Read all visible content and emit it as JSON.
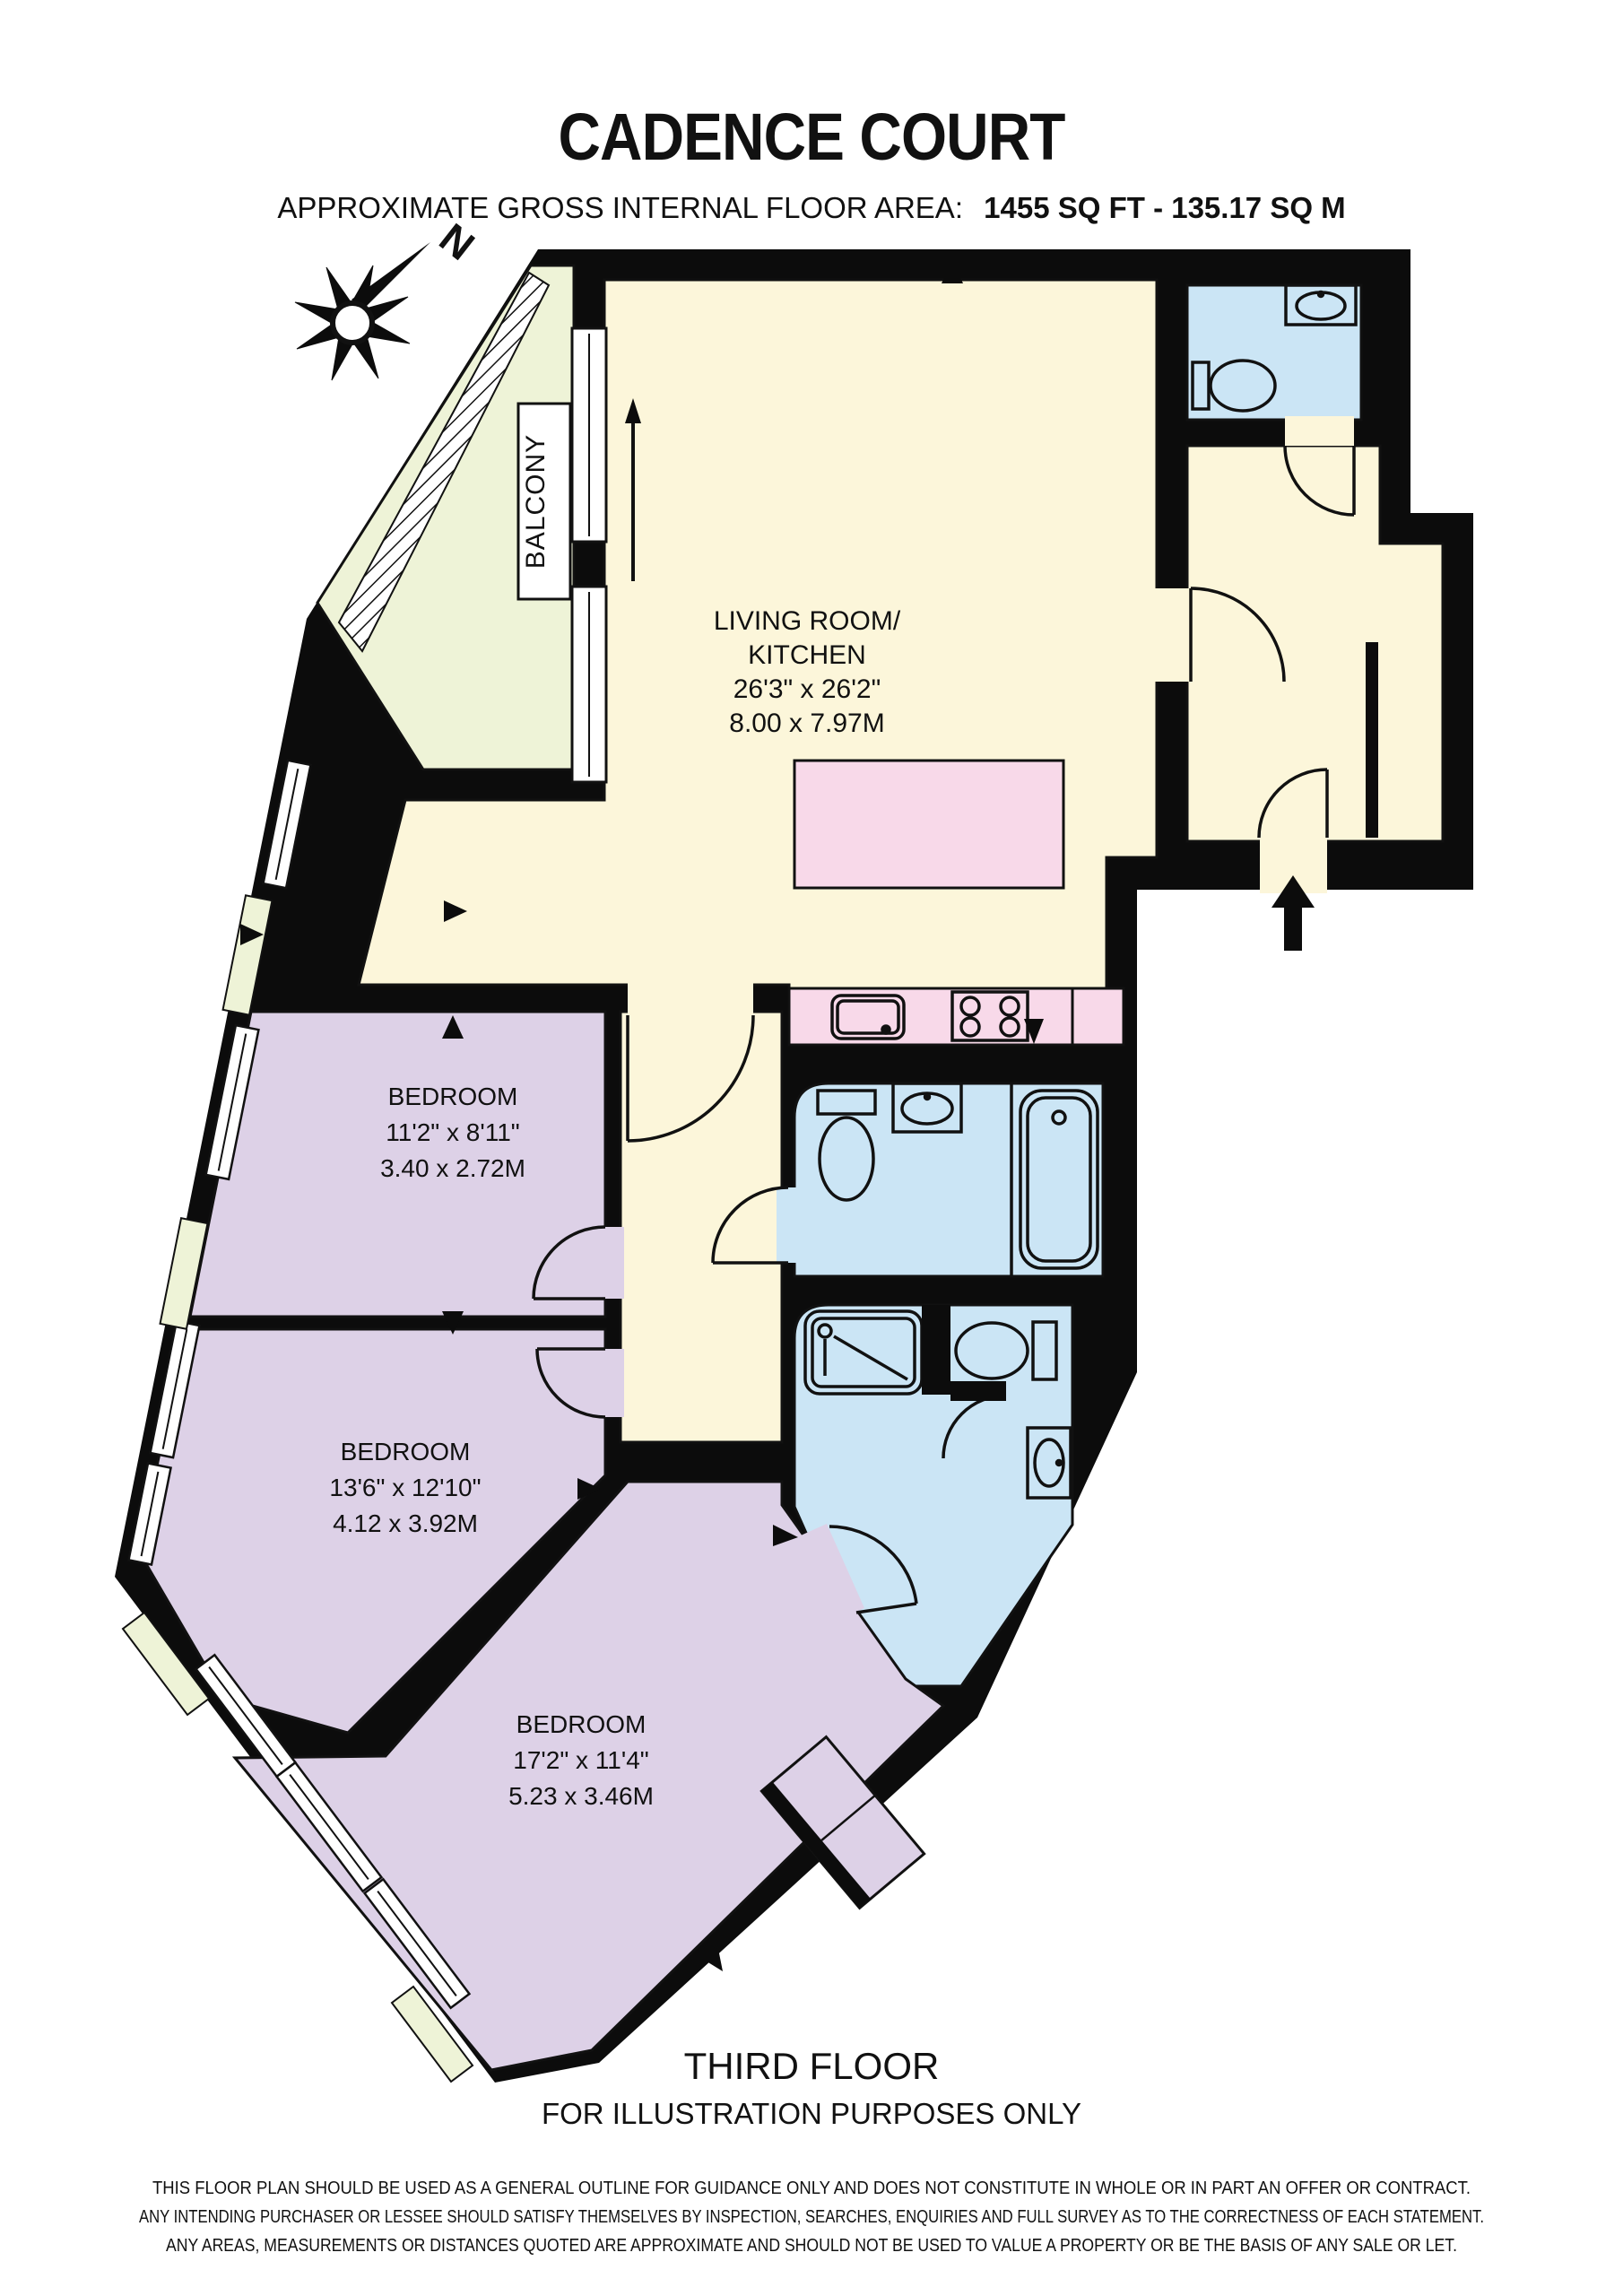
{
  "header": {
    "title": "CADENCE COURT",
    "area_label": "APPROXIMATE GROSS INTERNAL FLOOR AREA:",
    "area_value": "1455 SQ FT  -  135.17 SQ M"
  },
  "compass": {
    "north": "N"
  },
  "colors": {
    "wall": "#0c0c0c",
    "living": "#fcf6da",
    "bedroom": "#ddd1e7",
    "bathroom": "#cbe5f5",
    "kitchen": "#f8d9e9",
    "balcony": "#eef3d7"
  },
  "rooms": {
    "balcony": {
      "label": "BALCONY"
    },
    "living": {
      "name1": "LIVING ROOM/",
      "name2": "KITCHEN",
      "dims_imperial": "26'3\" x 26'2\"",
      "dims_metric": "8.00 x 7.97M"
    },
    "bedroom1": {
      "name": "BEDROOM",
      "dims_imperial": "11'2\" x 8'11\"",
      "dims_metric": "3.40 x 2.72M"
    },
    "bedroom2": {
      "name": "BEDROOM",
      "dims_imperial": "13'6\" x 12'10\"",
      "dims_metric": "4.12 x 3.92M"
    },
    "bedroom3": {
      "name": "BEDROOM",
      "dims_imperial": "17'2\" x 11'4\"",
      "dims_metric": "5.23 x 3.46M"
    }
  },
  "footer": {
    "floor": "THIRD FLOOR",
    "note": "FOR ILLUSTRATION PURPOSES ONLY",
    "disclaimer1": "THIS FLOOR PLAN SHOULD BE USED AS A GENERAL OUTLINE FOR GUIDANCE ONLY AND DOES NOT CONSTITUTE IN WHOLE OR IN PART AN OFFER OR CONTRACT.",
    "disclaimer2": "ANY INTENDING PURCHASER OR LESSEE SHOULD SATISFY THEMSELVES BY INSPECTION, SEARCHES, ENQUIRIES AND FULL SURVEY AS TO THE CORRECTNESS OF EACH STATEMENT.",
    "disclaimer3": "ANY AREAS, MEASUREMENTS OR DISTANCES QUOTED ARE APPROXIMATE AND SHOULD NOT BE USED TO VALUE A PROPERTY OR BE THE BASIS OF ANY SALE OR LET."
  }
}
